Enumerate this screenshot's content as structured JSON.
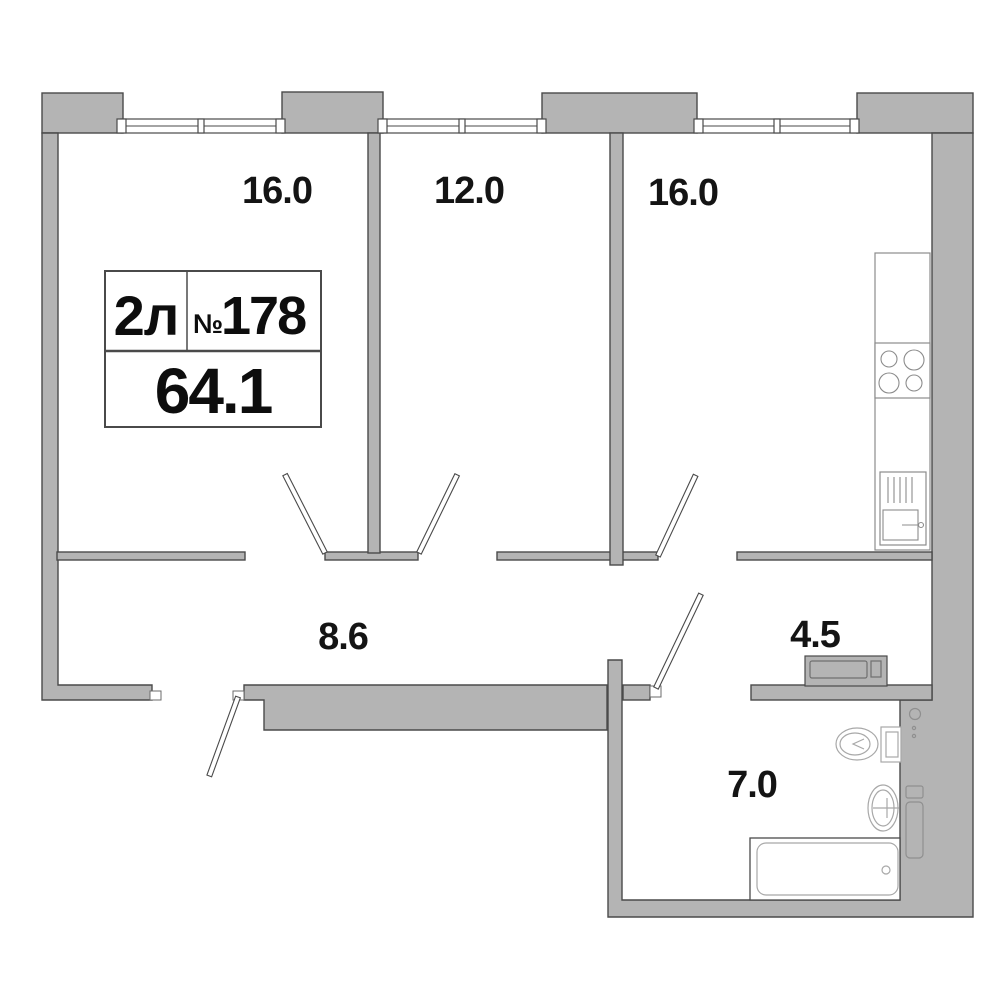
{
  "unit": {
    "type_label": "2л",
    "number_sign": "№",
    "number": "178",
    "total_area": "64.1"
  },
  "rooms": [
    {
      "id": "living-room",
      "area": "16.0"
    },
    {
      "id": "bedroom",
      "area": "12.0"
    },
    {
      "id": "kitchen-living-room",
      "area": "16.0"
    },
    {
      "id": "hallway",
      "area": "8.6"
    },
    {
      "id": "entry-niche",
      "area": "4.5"
    },
    {
      "id": "bathroom",
      "area": "7.0"
    }
  ],
  "fixtures": [
    "kitchen-counter",
    "cooktop",
    "kitchen-sink",
    "wardrobe",
    "toilet",
    "washbasin",
    "bathtub",
    "towel-rail",
    "vent-hole"
  ],
  "colors": {
    "background": "#ffffff",
    "wall_fill": "#b4b4b4",
    "wall_outline": "#4a4a4a",
    "fixture_outline": "#9c9c9c",
    "text": "#141414"
  }
}
